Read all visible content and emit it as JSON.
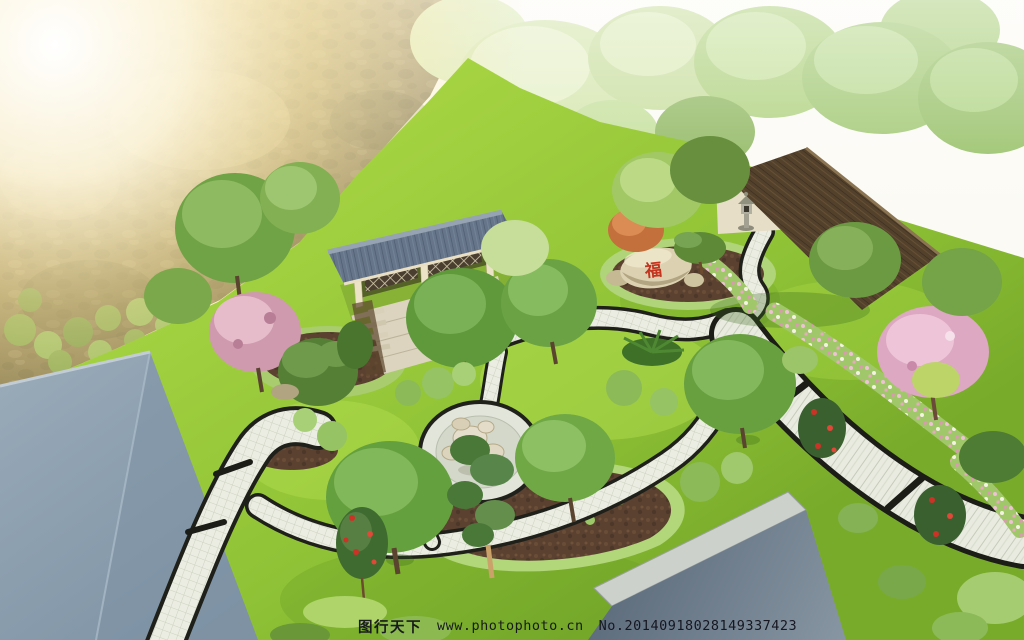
{
  "watermark": {
    "site_name": "图行天下",
    "url": "www.photophoto.cn",
    "serial": "No.20140918028149337423"
  },
  "rock": {
    "inscription": "福"
  },
  "palette": {
    "sun_glow": "#ffeaa6",
    "sky_white": "#fbfaf4",
    "hillside_brown": "#8a7a52",
    "lawn_green": "#8fc236",
    "lawn_light": "#b6e052",
    "path_paving": "#e9ebe0",
    "path_edge_black": "#1e2019",
    "pavilion_roof_gray": "#66758a",
    "wood_deck": "#dcd4be",
    "house_roof_brown": "#53412c",
    "house_wall_cream": "#e6dec6",
    "big_roof_blue_gray": "#8a9cac",
    "mulch_brown": "#5a4130",
    "blossom_pink": "#dca8c2",
    "rose_red": "#cc3326",
    "rock_tan": "#dcd2b2",
    "inscription_red": "#c4341e"
  }
}
